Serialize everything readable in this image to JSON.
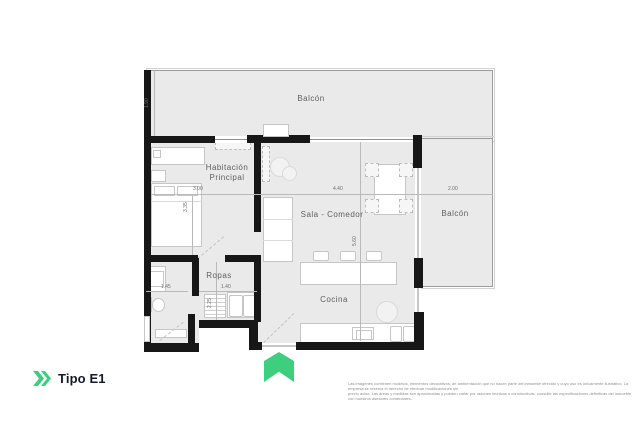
{
  "plan": {
    "labels": {
      "balcony_top": "Balcón",
      "bedroom_line1": "Habitación",
      "bedroom_line2": "Principal",
      "living": "Sala - Comedor",
      "balcony_right": "Balcón",
      "laundry": "Ropas",
      "kitchen": "Cocina"
    },
    "dimensions": {
      "balcony_top_depth": "1.90",
      "bedroom_width": "3.00",
      "bedroom_depth": "3.35",
      "living_width": "4.40",
      "living_depth": "5.60",
      "balcony_right_width": "2.00",
      "bathroom_width": "1.45",
      "laundry_width": "1.40",
      "laundry_depth": "2.25"
    },
    "colors": {
      "accent_green": "#3ECF7E",
      "floor_fill": "#EAEAEA",
      "wall": "#171717"
    }
  },
  "footer": {
    "unit_name": "Tipo E1",
    "disclaimer_line1": "Las imágenes contienen modelos, elementos decorativos, de ambientación que no hacen parte del inmueble ofrecido y cuyo uso es únicamente ilustrativo. La empresa se reserva el derecho de efectuar modificaciones sin",
    "disclaimer_line2": "previo aviso. Las áreas y medidas son aproximadas y pueden variar por razones técnicas o constructivas; consulte las especificaciones definitivas del inmueble con nuestros asesores comerciales."
  }
}
